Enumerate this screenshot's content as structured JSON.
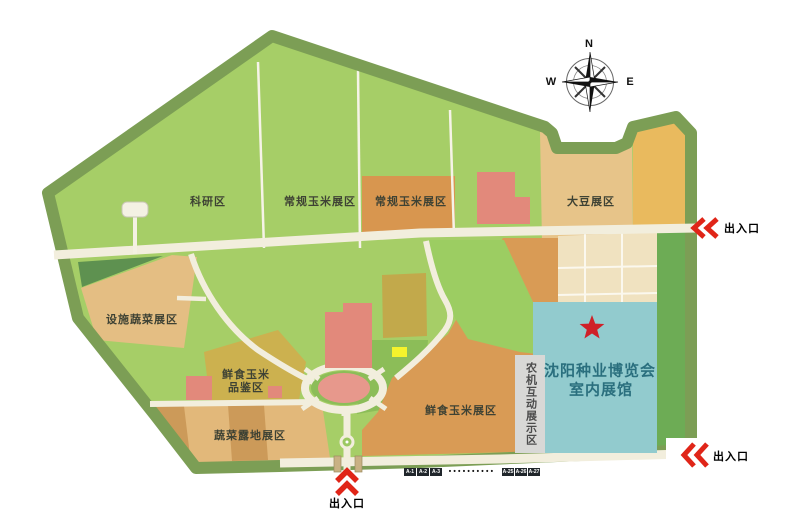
{
  "map": {
    "zones": {
      "research": "科研区",
      "regular_corn_1": "常规玉米展区",
      "regular_corn_2": "常规玉米展区",
      "soybean": "大豆展区",
      "facility_vegetable": "设施蔬菜展区",
      "fresh_corn_tasting_line1": "鲜食玉米",
      "fresh_corn_tasting_line2": "品鉴区",
      "vegetable_open_field": "蔬菜露地展区",
      "fresh_corn_exhibit": "鲜食玉米展区",
      "agri_machinery_interactive": "农机互动展示区",
      "indoor_hall_line1": "沈阳种业博览会",
      "indoor_hall_line2": "室内展馆"
    },
    "entrances": {
      "east": "出入口",
      "southeast": "出入口",
      "south": "出入口"
    },
    "compass": {
      "north": "N",
      "west": "W",
      "east": "E"
    },
    "stalls": {
      "first": [
        "A-1",
        "A-2",
        "A-3"
      ],
      "ellipsis": "••••••••••",
      "last": [
        "A-25",
        "A-26",
        "A-27"
      ]
    },
    "colors": {
      "boundary_green": "#7c9e55",
      "field_light_green": "#a6ce67",
      "field_medium_green": "#8cbd58",
      "field_dark_green": "#5e9150",
      "road_cream": "#f2eedd",
      "field_tan": "#e4be83",
      "field_golden": "#e9ba5e",
      "field_orange": "#d8964f",
      "field_olive": "#ccb14f",
      "building_salmon": "#e2897b",
      "plaza_pink": "#e7988c",
      "hall_teal": "#92cbce",
      "strip_gray": "#d8d8d6",
      "accent_red": "#e02518",
      "highlight_yellow": "#f5f32c",
      "stall_badge_bg": "#20262b"
    }
  }
}
